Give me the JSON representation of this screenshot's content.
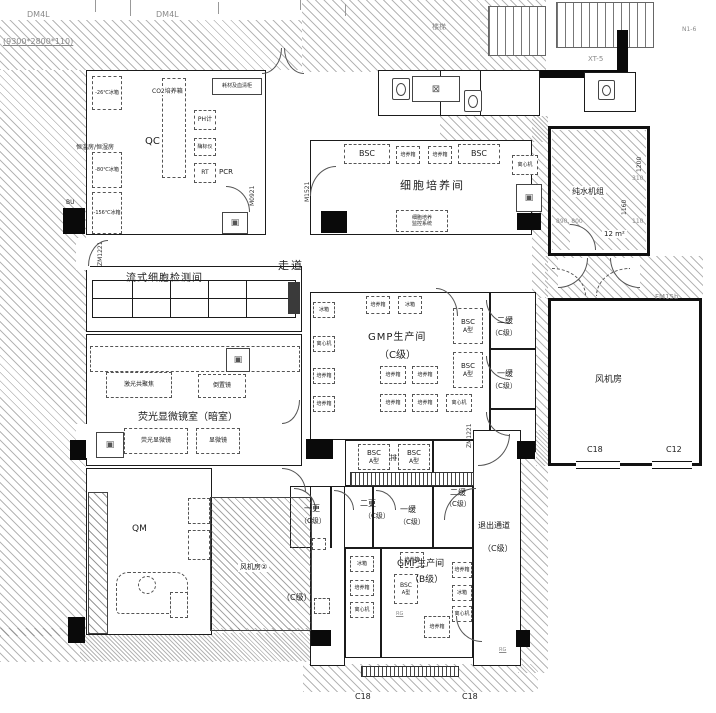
{
  "annotations": {
    "dm4l_a": "DM4L",
    "dm4l_b": "DM4L",
    "slab_dim": "(9300*2800*110)",
    "xt5": "XT-5",
    "stairs": "楼梯",
    "n1": "N1-6",
    "corridor": "走道",
    "c18_a": "C18",
    "c18_b": "C18",
    "fan_c18": "C18",
    "fan_c12": "C12",
    "fm15b": "FM15b",
    "rg_a": "RG",
    "rg_b": "RG",
    "pure_water_area": "12 m²"
  },
  "dims": {
    "d1200": "1200",
    "d310": "310",
    "d1160": "1160",
    "d110": "110",
    "d890_800": "890, 800"
  },
  "door_codes": {
    "zm1221_left": "ZM1221",
    "m0921": "M0921",
    "m1521": "M1521",
    "zm1221_right": "ZM1221"
  },
  "rooms": {
    "qc": "QC",
    "cell_culture": "细胞培养间",
    "flow_cytometry": "流式细胞检测间",
    "fluorescence": "荧光显微镜室（暗室）",
    "qm": "QM",
    "gmp_c": "GMP生产间",
    "gmp_c_class": "（C级）",
    "gmp_b": "GMP生产间",
    "gmp_b_class": "（B级）",
    "fan_room": "风机房",
    "fan_room_2": "风机房②",
    "pure_water": "纯水机组",
    "exit_corridor": "退出通道",
    "exit_class": "（C级）",
    "buffer2_right": "二缓",
    "buffer2_right_class": "（C级）",
    "buffer1_right": "一缓",
    "buffer1_right_class": "（C级）",
    "change1": "一更",
    "change1_class": "（C级）",
    "change2": "二更",
    "change2_class": "（C级）",
    "buffer1_mid": "一缓",
    "buffer1_mid_class": "（C级）",
    "buffer2_mid": "二缓",
    "buffer2_mid_class": "（C级）",
    "corridor_c_class": "（C级）"
  },
  "equipment": {
    "freezer_26": "-26℃冰箱",
    "temp_rooms": "恒温房/恒湿房",
    "freezer_80": "-80℃冰箱",
    "freezer_156": "-156℃冰箱",
    "co2_incubator": "CO2培养箱",
    "ph_meter": "PH计",
    "plate_reader": "酶标仪",
    "rt": "RT",
    "pcr": "PCR",
    "cabinet": "耗材及血清柜",
    "bu": "BU",
    "bsc": "BSC",
    "bsc_type": "A型",
    "incubator": "培养箱",
    "centrifuge": "离心机",
    "fridge": "冰箱",
    "monitor_line1": "细胞培养",
    "monitor_line2": "监控系统",
    "confocal": "激光共聚焦",
    "inverted_scope": "倒置镜",
    "fluor_scope": "荧光显微镜",
    "microscope": "显微镜",
    "exhaust": "排"
  },
  "icons": {
    "floor_drain": "⊠",
    "pass_box": "▣"
  }
}
